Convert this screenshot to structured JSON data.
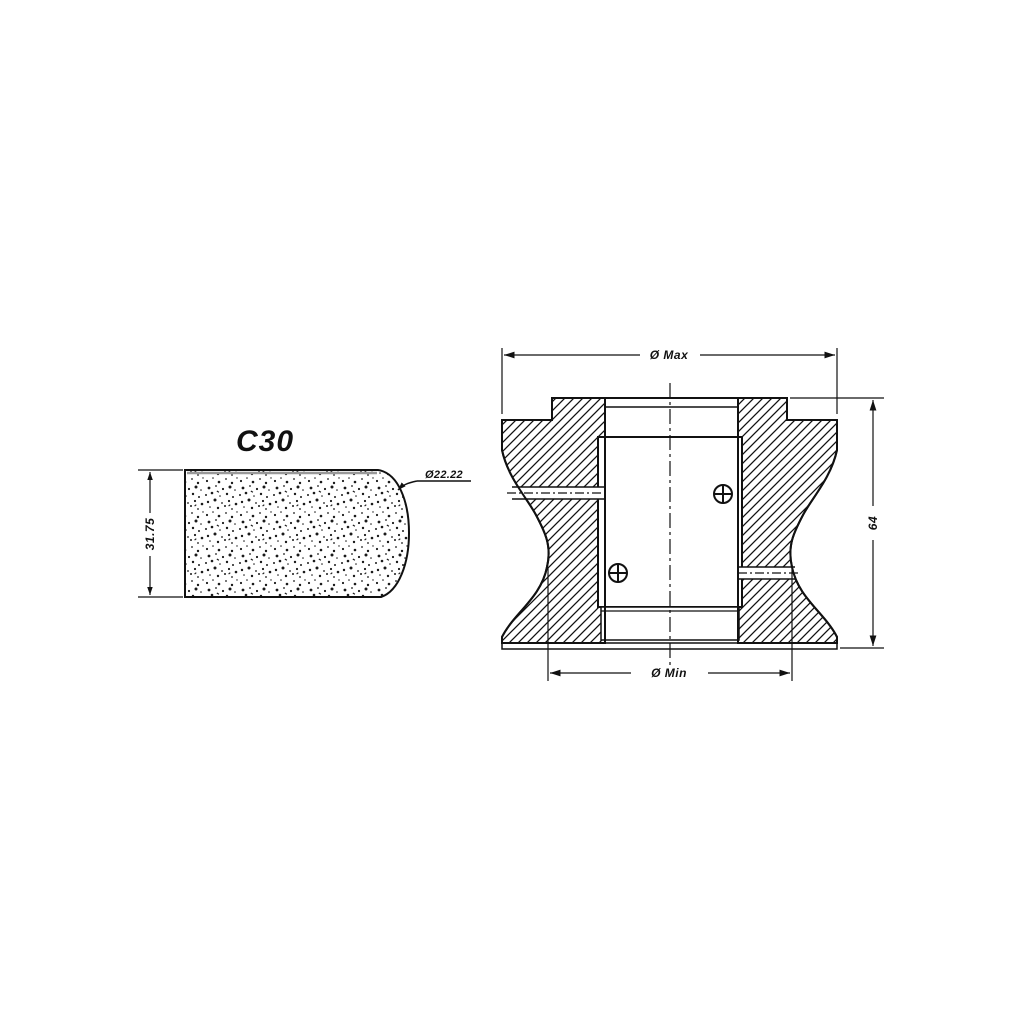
{
  "colors": {
    "line": "#111111",
    "background": "#ffffff",
    "gray_edge": "#999999"
  },
  "profile_view": {
    "title": "C30",
    "thickness_dim": "31.75",
    "radius_callout": "Ø22.22"
  },
  "section_view": {
    "diameter_max_label": "Ø Max",
    "diameter_min_label": "Ø Min",
    "height_label": "64"
  }
}
